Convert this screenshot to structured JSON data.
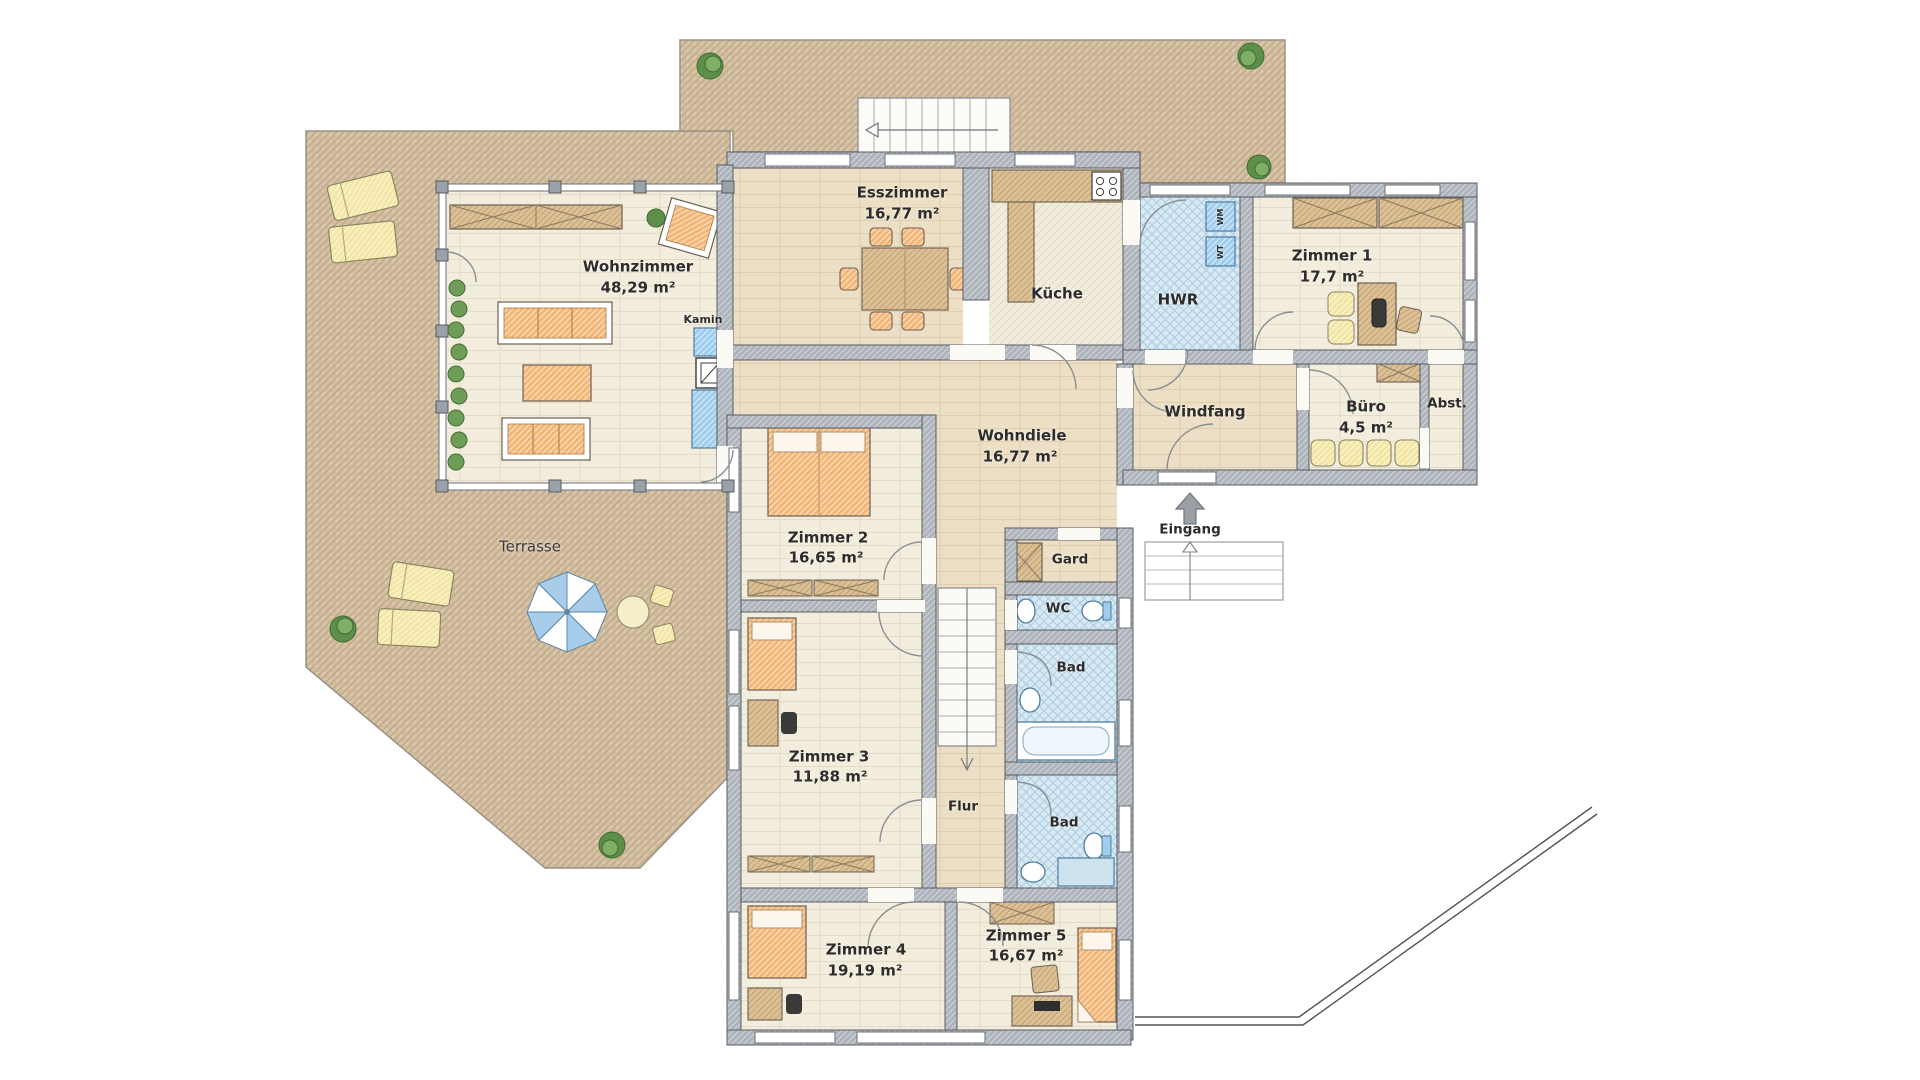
{
  "plan": {
    "type": "floor-plan",
    "language": "de",
    "rooms": [
      {
        "id": "wohnzimmer",
        "label": "Wohnzimmer",
        "area": "48,29 m²"
      },
      {
        "id": "esszimmer",
        "label": "Esszimmer",
        "area": "16,77 m²"
      },
      {
        "id": "kueche",
        "label": "Küche",
        "area": ""
      },
      {
        "id": "hwr",
        "label": "HWR",
        "area": ""
      },
      {
        "id": "zimmer1",
        "label": "Zimmer 1",
        "area": "17,7 m²"
      },
      {
        "id": "windfang",
        "label": "Windfang",
        "area": ""
      },
      {
        "id": "buero",
        "label": "Büro",
        "area": "4,5 m²"
      },
      {
        "id": "abstellraum",
        "label": "Abst.",
        "area": ""
      },
      {
        "id": "wohndiele",
        "label": "Wohndiele",
        "area": "16,77 m²"
      },
      {
        "id": "zimmer2",
        "label": "Zimmer 2",
        "area": "16,65 m²"
      },
      {
        "id": "garderobe",
        "label": "Gard",
        "area": ""
      },
      {
        "id": "wc",
        "label": "WC",
        "area": ""
      },
      {
        "id": "bad-oben",
        "label": "Bad",
        "area": ""
      },
      {
        "id": "zimmer3",
        "label": "Zimmer 3",
        "area": "11,88 m²"
      },
      {
        "id": "flur",
        "label": "Flur",
        "area": ""
      },
      {
        "id": "bad-unten",
        "label": "Bad",
        "area": ""
      },
      {
        "id": "zimmer4",
        "label": "Zimmer 4",
        "area": "19,19 m²"
      },
      {
        "id": "zimmer5",
        "label": "Zimmer 5",
        "area": "16,67 m²"
      }
    ],
    "outdoor": {
      "terrasse": "Terrasse",
      "eingang": "Eingang"
    },
    "features": {
      "kamin": "Kamin"
    },
    "appliances": {
      "wm": "WM",
      "wt": "WT"
    },
    "colors": {
      "terrace": "#d2bda0",
      "wall": "#aeb4bb",
      "floor_light": "#f3eddd",
      "floor_beige": "#ecdfc5",
      "wet_room": "#d8e9f3",
      "furniture_orange": "#f2b679",
      "furniture_tan": "#dcc096",
      "furniture_yellow": "#f3e6a5",
      "kamin_blue": "#9fcdeb",
      "plant_green": "#5e8f4a"
    }
  }
}
